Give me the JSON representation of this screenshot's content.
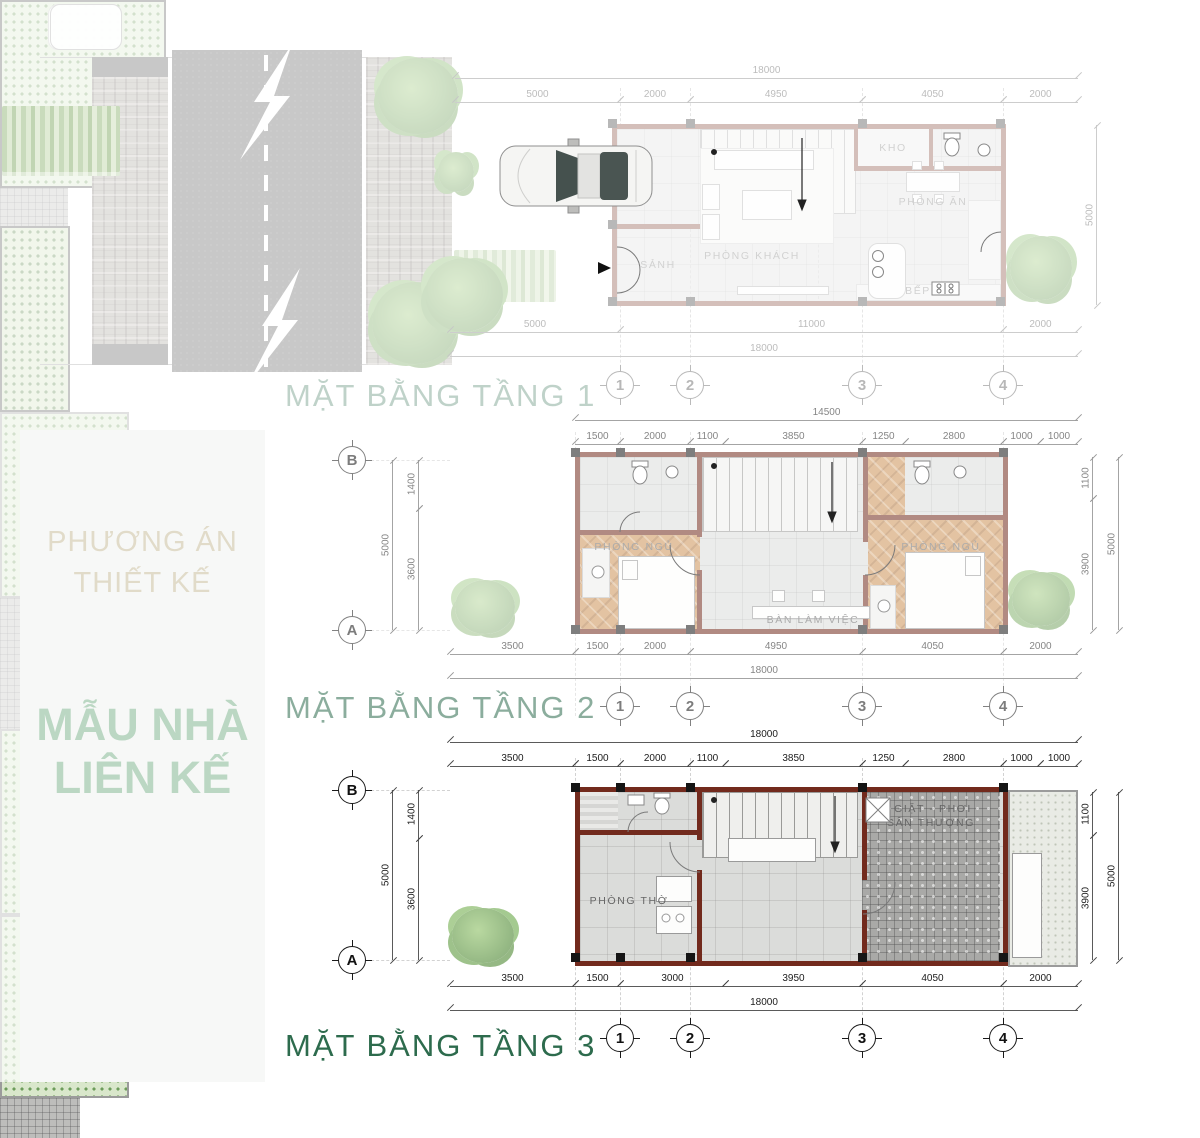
{
  "colors": {
    "title_green": "#2d6b4d",
    "sidebar_heading_gold": "#9b894d",
    "sidebar_title_green": "#1e7c3a",
    "wall_maroon": "#722a1d",
    "driveway_green": "#6d9c5b",
    "road_asphalt": "#4b4b49"
  },
  "sidebar": {
    "heading_line1": "PHƯƠNG ÁN",
    "heading_line2": "THIẾT KẾ",
    "title_line1": "MẪU NHÀ",
    "title_line2": "LIÊN KẾ"
  },
  "floor1": {
    "title": "MẶT BẰNG TẦNG 1",
    "dim_top_overall": "18000",
    "dim_top": [
      "5000",
      "2000",
      "4950",
      "4050",
      "2000"
    ],
    "dim_bottom": [
      "5000",
      "11000",
      "2000"
    ],
    "dim_bottom_overall": "18000",
    "dim_right_overall": "5000",
    "grid_cols": [
      "1",
      "2",
      "3",
      "4"
    ],
    "rooms": {
      "sanh": "SẢNH",
      "khach": "PHÒNG KHÁCH",
      "an": "PHÒNG ĂN",
      "kho": "KHO",
      "bep": "BẾP"
    }
  },
  "floor2": {
    "title": "MẶT BẰNG TẦNG 2",
    "dim_top_overall": "14500",
    "dim_top": [
      "1500",
      "2000",
      "1100",
      "3850",
      "1250",
      "2800",
      "1000",
      "1000"
    ],
    "dim_bottom": [
      "3500",
      "1500",
      "2000",
      "4950",
      "4050",
      "2000"
    ],
    "dim_bottom_overall": "18000",
    "dim_left": [
      "1400",
      "3600"
    ],
    "dim_left_overall": "5000",
    "dim_right": [
      "1100",
      "3900"
    ],
    "dim_right_overall": "5000",
    "grid_cols": [
      "1",
      "2",
      "3",
      "4"
    ],
    "grid_rows": [
      "B",
      "A"
    ],
    "rooms": {
      "ngu_trai": "PHÒNG NGỦ",
      "ngu_phai": "PHÒNG NGỦ",
      "ban_lam_viec": "BÀN LÀM VIỆC"
    }
  },
  "floor3": {
    "title": "MẶT BẰNG TẦNG 3",
    "dim_top_overall": "18000",
    "dim_top": [
      "3500",
      "1500",
      "2000",
      "1100",
      "3850",
      "1250",
      "2800",
      "1000",
      "1000"
    ],
    "dim_bottom": [
      "3500",
      "1500",
      "3000",
      "3950",
      "4050",
      "2000"
    ],
    "dim_bottom_overall": "18000",
    "dim_left": [
      "1400",
      "3600"
    ],
    "dim_left_overall": "5000",
    "dim_right": [
      "1100",
      "3900"
    ],
    "dim_right_overall": "5000",
    "grid_cols": [
      "1",
      "2",
      "3",
      "4"
    ],
    "grid_rows": [
      "B",
      "A"
    ],
    "rooms": {
      "tho": "PHÒNG THỜ",
      "giat_line1": "GIẶT - PHƠI",
      "giat_line2": "SÂN THƯỢNG"
    }
  }
}
